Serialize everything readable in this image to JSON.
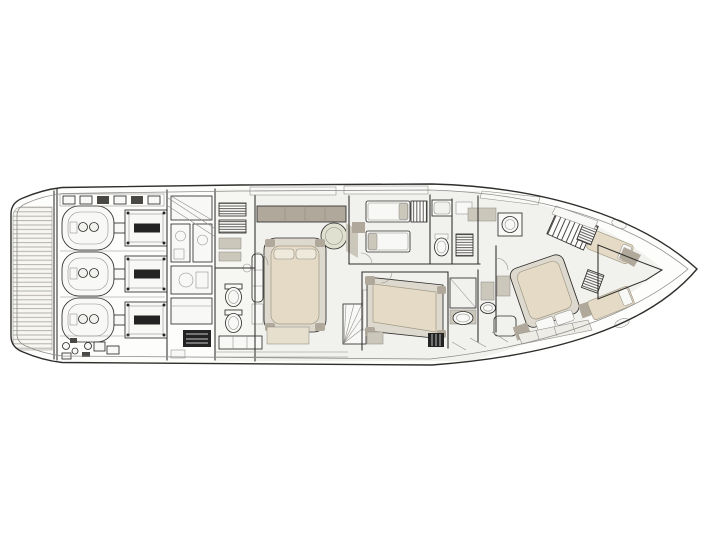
{
  "diagram": {
    "type": "yacht-deck-plan",
    "title": "Lower deck general arrangement",
    "orientation": "bow-right",
    "engine_count": 3,
    "bed_count": 7,
    "areas": [
      {
        "id": "swim-platform",
        "desc": "teak swim platform at stern"
      },
      {
        "id": "engine-room",
        "desc": "engine room with three engines and shaft pods"
      },
      {
        "id": "machinery",
        "desc": "auxiliary machinery, pumps and systems units"
      },
      {
        "id": "crew-area",
        "desc": "crew quarters with lockers, two WCs and bench"
      },
      {
        "id": "master-cabin",
        "desc": "full-beam master cabin with double bed, sofa, pouf and cabinet"
      },
      {
        "id": "twin-cabin",
        "desc": "twin guest cabin with two single beds and wardrobe"
      },
      {
        "id": "bathroom-top",
        "desc": "guest bathroom with shower and WC"
      },
      {
        "id": "guest-cabin",
        "desc": "double guest cabin with en-suite shower room"
      },
      {
        "id": "vip-cabin",
        "desc": "VIP double cabin forward with vanity and en-suite"
      },
      {
        "id": "bow-cabin",
        "desc": "forepeak cabin with two angled berths"
      }
    ]
  },
  "colors": {
    "background": "#ffffff",
    "paper": "#fdfdfc",
    "line": "#2f2e2c",
    "line_soft": "#8f8d88",
    "floor": "#f1f1ee",
    "floor_soft": "#f6f6f3",
    "white_fill": "#f8f8f6",
    "bed": "#e4dac5",
    "bed_soft": "#e6dfce",
    "bed_frame": "#ddd9ce",
    "furniture_tan": "#b0a89a",
    "furniture_light": "#ccc7bb",
    "pouf": "#dfe0cf",
    "pillow": "#efe9db",
    "vanity": "#edece6",
    "dark": "#232323",
    "hatch": "#4a4845",
    "deck_line": "#b5b1a8"
  }
}
